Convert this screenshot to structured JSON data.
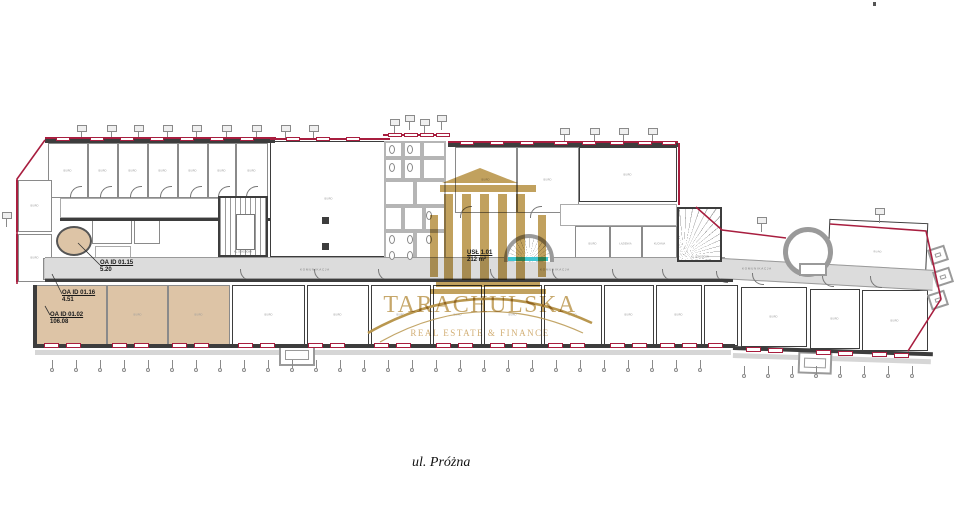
{
  "watermark": {
    "brand": "TARACHULSKA",
    "tagline": "REAL ESTATE & FINANCE"
  },
  "street_label": "ul. Próżna",
  "colors": {
    "accent_red": "#a81e3f",
    "gold": "#bd9a52",
    "tan_room": "#ddc4a6",
    "teal": "#3fc4d1"
  },
  "annotations": [
    {
      "id": "OA ID 01.15",
      "area": "5.20",
      "x": 100,
      "y": 260
    },
    {
      "id": "OA ID 01.16",
      "area": "4.51",
      "x": 62,
      "y": 290
    },
    {
      "id": "OA ID 01.02",
      "area": "106.08",
      "x": 50,
      "y": 312
    },
    {
      "id": "USŁ 1.01",
      "area": "212 m²",
      "x": 467,
      "y": 250
    }
  ],
  "corridor_labels": [
    {
      "text": "KOMUNIKACJA",
      "x": 300,
      "y": 267
    },
    {
      "text": "KOMUNIKACJA",
      "x": 540,
      "y": 267
    },
    {
      "text": "KOMUNIKACJA",
      "x": 742,
      "y": 266
    }
  ],
  "stairs": {
    "left": "KL. SCHODOWA",
    "right": "KL. SCHODOWA"
  },
  "rooms": [
    {
      "label": "BIURO",
      "x": 48,
      "y": 143,
      "w": 40,
      "h": 55
    },
    {
      "label": "BIURO",
      "x": 88,
      "y": 143,
      "w": 30,
      "h": 55
    },
    {
      "label": "BIURO",
      "x": 118,
      "y": 143,
      "w": 30,
      "h": 55
    },
    {
      "label": "BIURO",
      "x": 148,
      "y": 143,
      "w": 30,
      "h": 55
    },
    {
      "label": "BIURO",
      "x": 178,
      "y": 143,
      "w": 30,
      "h": 55
    },
    {
      "label": "BIURO",
      "x": 208,
      "y": 143,
      "w": 28,
      "h": 55
    },
    {
      "label": "BIURO",
      "x": 236,
      "y": 143,
      "w": 32,
      "h": 55
    },
    {
      "label": "BIURO",
      "x": 270,
      "y": 141,
      "w": 118,
      "h": 116,
      "cls": "dark"
    },
    {
      "label": "",
      "x": 60,
      "y": 198,
      "w": 208,
      "h": 20,
      "cls": "thin"
    },
    {
      "label": "BIURO",
      "x": 18,
      "y": 180,
      "w": 34,
      "h": 52,
      "cls": "redge"
    },
    {
      "label": "BIURO",
      "x": 18,
      "y": 234,
      "w": 34,
      "h": 48,
      "cls": "redge"
    },
    {
      "label": "",
      "x": 92,
      "y": 218,
      "w": 40,
      "h": 26
    },
    {
      "label": "",
      "x": 134,
      "y": 218,
      "w": 26,
      "h": 26
    },
    {
      "label": "",
      "x": 95,
      "y": 246,
      "w": 36,
      "h": 12,
      "cls": "thin"
    },
    {
      "label": "",
      "x": 43,
      "y": 258,
      "w": 20,
      "h": 22,
      "fill": "#c9c9c9"
    },
    {
      "label": "",
      "x": 384,
      "y": 141,
      "w": 19,
      "h": 17,
      "cls": "lt"
    },
    {
      "label": "",
      "x": 403,
      "y": 141,
      "w": 19,
      "h": 17,
      "cls": "lt"
    },
    {
      "label": "",
      "x": 422,
      "y": 141,
      "w": 24,
      "h": 17,
      "cls": "lt"
    },
    {
      "label": "",
      "x": 384,
      "y": 158,
      "w": 19,
      "h": 22,
      "cls": "lt"
    },
    {
      "label": "",
      "x": 403,
      "y": 158,
      "w": 19,
      "h": 22,
      "cls": "lt"
    },
    {
      "label": "",
      "x": 422,
      "y": 158,
      "w": 24,
      "h": 22,
      "cls": "lt"
    },
    {
      "label": "",
      "x": 384,
      "y": 180,
      "w": 31,
      "h": 26,
      "cls": "lt"
    },
    {
      "label": "",
      "x": 415,
      "y": 180,
      "w": 31,
      "h": 26,
      "cls": "lt"
    },
    {
      "label": "",
      "x": 384,
      "y": 206,
      "w": 19,
      "h": 25,
      "cls": "lt"
    },
    {
      "label": "",
      "x": 403,
      "y": 206,
      "w": 21,
      "h": 25,
      "cls": "lt"
    },
    {
      "label": "",
      "x": 424,
      "y": 206,
      "w": 22,
      "h": 25,
      "cls": "lt"
    },
    {
      "label": "",
      "x": 384,
      "y": 231,
      "w": 31,
      "h": 32,
      "cls": "lt"
    },
    {
      "label": "",
      "x": 415,
      "y": 231,
      "w": 31,
      "h": 32,
      "cls": "lt"
    },
    {
      "label": "BIURO",
      "x": 455,
      "y": 147,
      "w": 62,
      "h": 66
    },
    {
      "label": "BIURO",
      "x": 517,
      "y": 147,
      "w": 62,
      "h": 66
    },
    {
      "label": "BIURO",
      "x": 579,
      "y": 147,
      "w": 98,
      "h": 55,
      "cls": "dark"
    },
    {
      "label": "",
      "x": 560,
      "y": 204,
      "w": 117,
      "h": 22,
      "cls": "thin"
    },
    {
      "label": "BIURO",
      "x": 575,
      "y": 226,
      "w": 35,
      "h": 36
    },
    {
      "label": "ŁAZIENKA",
      "x": 610,
      "y": 226,
      "w": 32,
      "h": 36
    },
    {
      "label": "KUCHNIA",
      "x": 642,
      "y": 226,
      "w": 35,
      "h": 36
    },
    {
      "label": "BIURO",
      "x": 828,
      "y": 221,
      "w": 99,
      "h": 62,
      "cls": "dark tilt"
    },
    {
      "label": "BIURO",
      "x": 35,
      "y": 285,
      "w": 72,
      "h": 60,
      "fill": "#ddc4a6"
    },
    {
      "label": "BIURO",
      "x": 107,
      "y": 285,
      "w": 61,
      "h": 60,
      "fill": "#ddc4a6"
    },
    {
      "label": "BIURO",
      "x": 168,
      "y": 285,
      "w": 62,
      "h": 60,
      "fill": "#ddc4a6"
    },
    {
      "label": "BIURO",
      "x": 232,
      "y": 285,
      "w": 73,
      "h": 60,
      "cls": "dark"
    },
    {
      "label": "BIURO",
      "x": 307,
      "y": 285,
      "w": 62,
      "h": 60,
      "cls": "dark"
    },
    {
      "label": "BIURO",
      "x": 371,
      "y": 285,
      "w": 60,
      "h": 60,
      "cls": "dark"
    },
    {
      "label": "BIURO",
      "x": 433,
      "y": 285,
      "w": 49,
      "h": 60,
      "cls": "dark"
    },
    {
      "label": "BIURO",
      "x": 484,
      "y": 285,
      "w": 58,
      "h": 60,
      "cls": "dark"
    },
    {
      "label": "BIURO",
      "x": 544,
      "y": 285,
      "w": 58,
      "h": 60,
      "cls": "dark"
    },
    {
      "label": "BIURO",
      "x": 604,
      "y": 285,
      "w": 50,
      "h": 60,
      "cls": "dark"
    },
    {
      "label": "BIURO",
      "x": 656,
      "y": 285,
      "w": 46,
      "h": 60,
      "cls": "dark"
    },
    {
      "label": "",
      "x": 704,
      "y": 285,
      "w": 34,
      "h": 61,
      "cls": "dark"
    },
    {
      "label": "BIURO",
      "x": 741,
      "y": 287,
      "w": 66,
      "h": 60,
      "cls": "dark"
    },
    {
      "label": "BIURO",
      "x": 810,
      "y": 289,
      "w": 50,
      "h": 60,
      "cls": "dark"
    },
    {
      "label": "BIURO",
      "x": 862,
      "y": 290,
      "w": 66,
      "h": 61,
      "cls": "dark"
    }
  ]
}
